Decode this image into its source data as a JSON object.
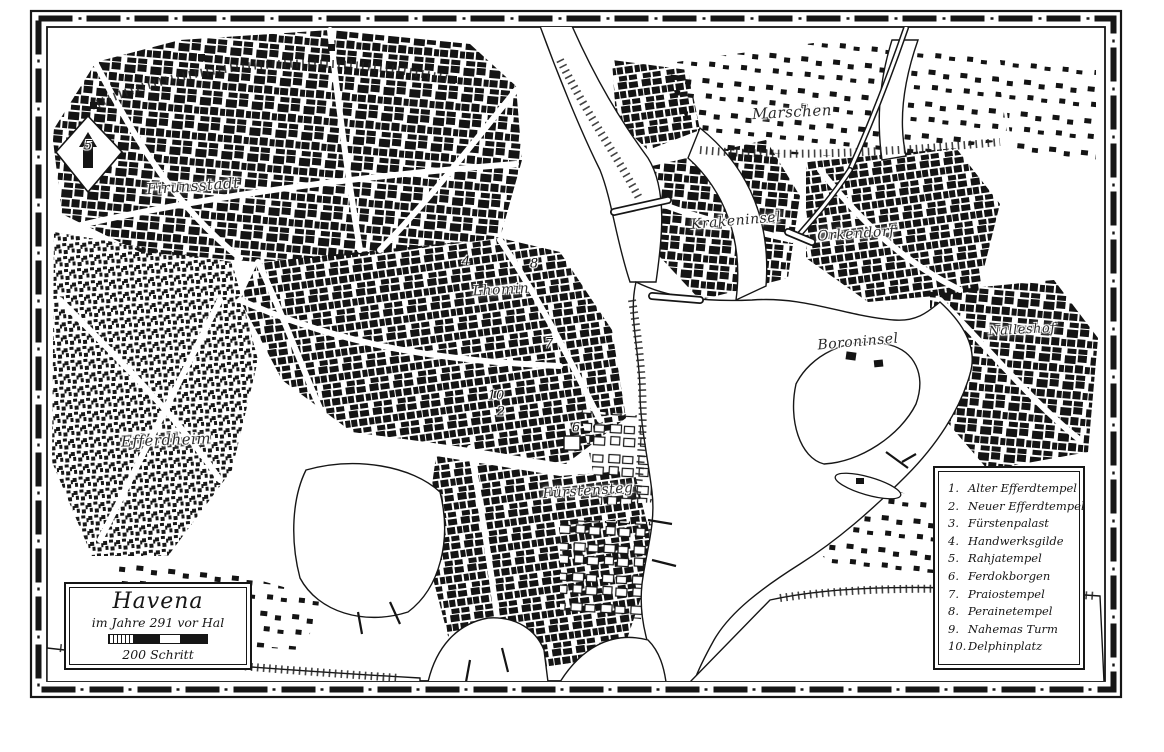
{
  "map": {
    "title": "Havena",
    "subtitle": "im Jahre 291 vor Hal",
    "scale_label": "200 Schritt"
  },
  "legend": {
    "items": [
      {
        "number": "1.",
        "name": "Alter Efferdtempel"
      },
      {
        "number": "2.",
        "name": "Neuer Efferdtempel"
      },
      {
        "number": "3.",
        "name": "Fürstenpalast"
      },
      {
        "number": "4.",
        "name": "Handwerksgilde"
      },
      {
        "number": "5.",
        "name": "Rahjatempel"
      },
      {
        "number": "6.",
        "name": "Ferdokborgen"
      },
      {
        "number": "7.",
        "name": "Praiostempel"
      },
      {
        "number": "8.",
        "name": "Perainetempel"
      },
      {
        "number": "9.",
        "name": "Nahemas Turm"
      },
      {
        "number": "10.",
        "name": "Delphinplatz"
      }
    ]
  },
  "places": [
    {
      "name": "Firunsstadt",
      "x": 193,
      "y": 186,
      "size": 15,
      "rot": -4
    },
    {
      "name": "Lhomin",
      "x": 501,
      "y": 290,
      "size": 14,
      "rot": -3
    },
    {
      "name": "Efferdheim",
      "x": 166,
      "y": 440,
      "size": 15,
      "rot": -2
    },
    {
      "name": "Fürstensteg",
      "x": 588,
      "y": 491,
      "size": 14,
      "rot": -4
    },
    {
      "name": "Marschen",
      "x": 792,
      "y": 112,
      "size": 15,
      "rot": -3
    },
    {
      "name": "Krakeninsel",
      "x": 736,
      "y": 221,
      "size": 14,
      "rot": -5
    },
    {
      "name": "Orkendorf",
      "x": 856,
      "y": 234,
      "size": 14,
      "rot": -4
    },
    {
      "name": "Boroninsel",
      "x": 858,
      "y": 342,
      "size": 14,
      "rot": -5
    },
    {
      "name": "Nalleshof",
      "x": 1022,
      "y": 330,
      "size": 13,
      "rot": -3
    }
  ],
  "markers": [
    {
      "number": "5",
      "x": 88,
      "y": 146
    },
    {
      "number": "4",
      "x": 466,
      "y": 262
    },
    {
      "number": "8",
      "x": 534,
      "y": 264
    },
    {
      "number": "7",
      "x": 549,
      "y": 344
    },
    {
      "number": "10",
      "x": 496,
      "y": 396
    },
    {
      "number": "2",
      "x": 501,
      "y": 412
    },
    {
      "number": "6",
      "x": 576,
      "y": 428
    }
  ],
  "colors": {
    "ink": "#161616",
    "paper": "#ffffff"
  }
}
